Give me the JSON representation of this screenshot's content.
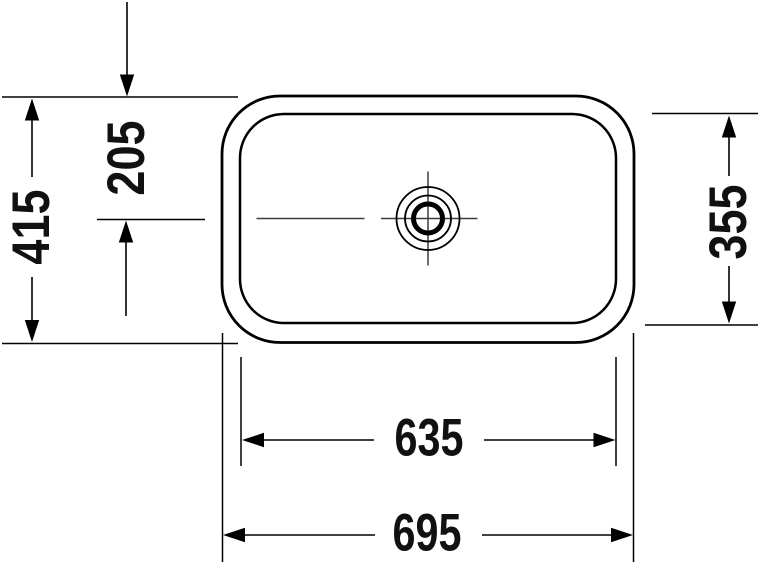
{
  "drawing": {
    "view": "washbasin-top-view-technical-drawing",
    "colors": {
      "background": "#ffffff",
      "line": "#000000",
      "centerline": "#3c3c3c",
      "text": "#111111"
    },
    "labels": {
      "overall_width": "695",
      "bowl_width": "635",
      "overall_depth": "415",
      "bowl_depth": "355",
      "edge_to_drain_center": "205"
    }
  }
}
